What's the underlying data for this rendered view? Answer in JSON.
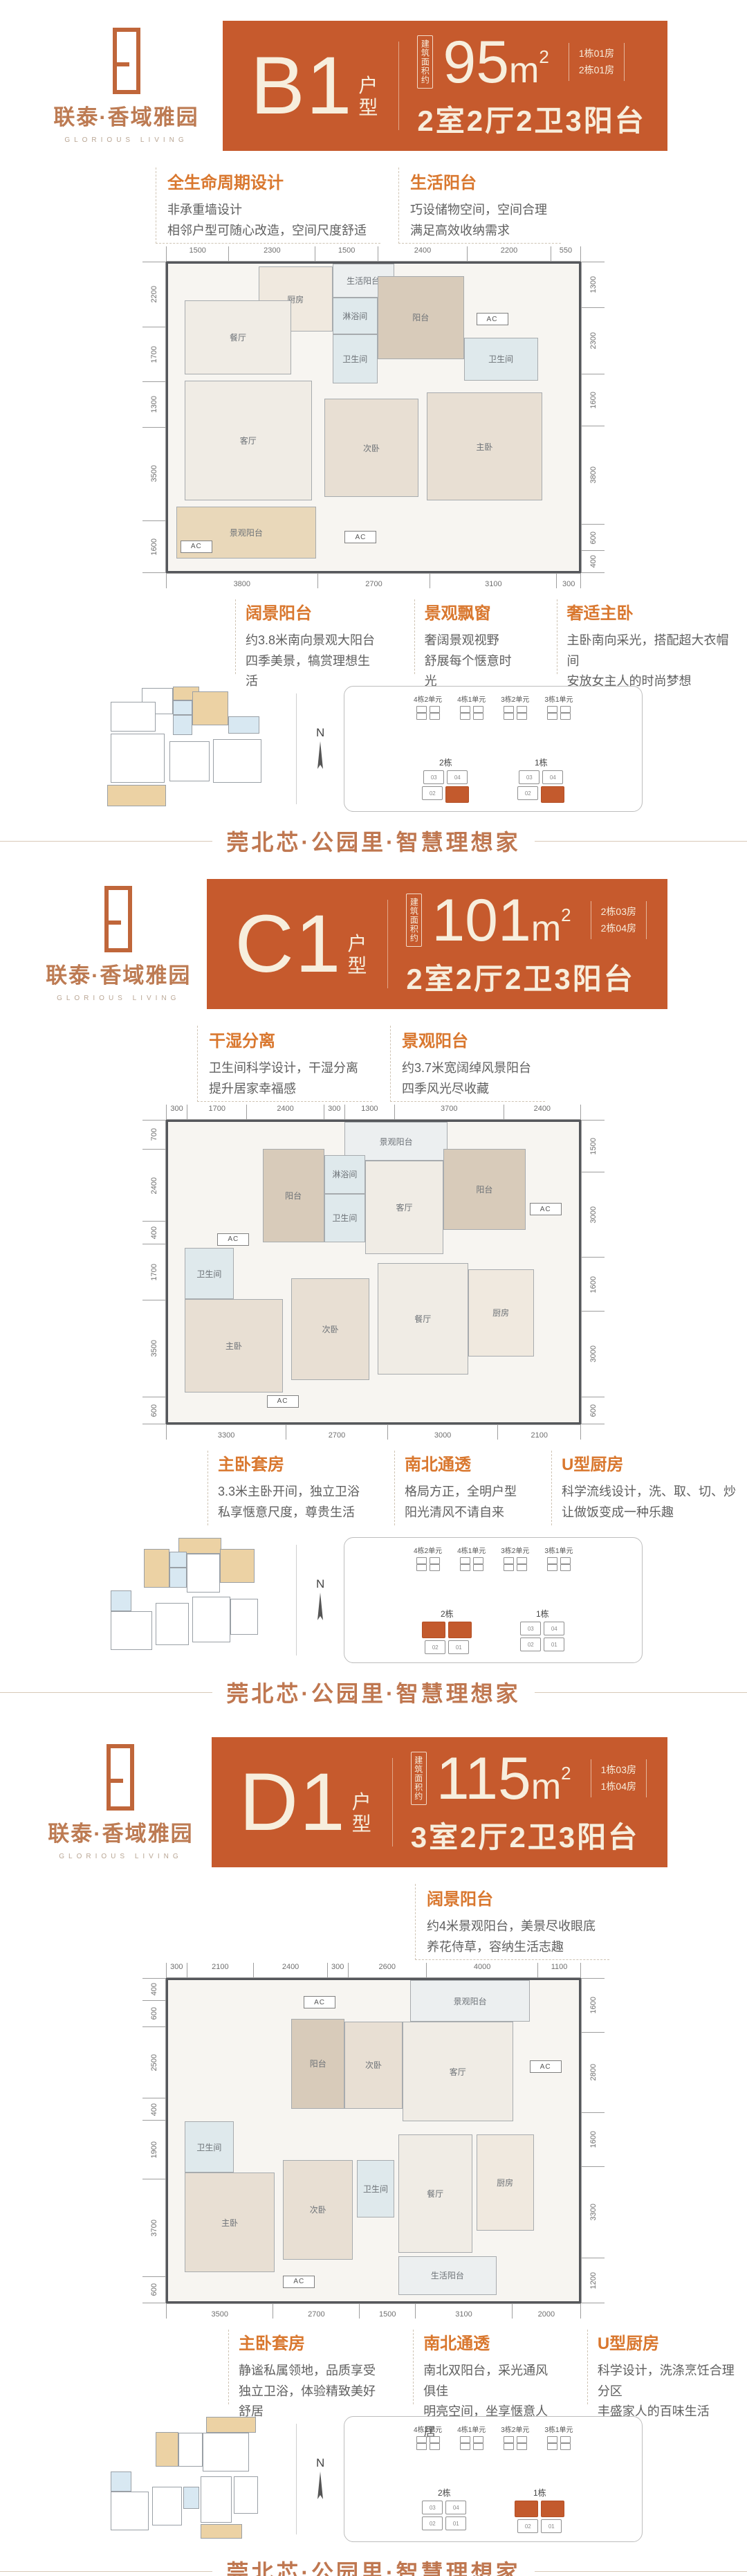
{
  "brand": {
    "cn": "联泰·香域雅园",
    "en": "GLORIOUS LIVING"
  },
  "footer_slogan": "莞北芯·公园里·智慧理想家",
  "colors": {
    "banner_orange": "#c65a2d",
    "title_orange": "#d9772e",
    "copper": "#bd7b53",
    "highlight": "#c35a2d"
  },
  "compass_label": "N",
  "sections": [
    {
      "banner": {
        "code": "B1",
        "suffix_1": "户",
        "suffix_2": "型",
        "area_label": "建筑面积约",
        "area": "95",
        "area_unit": "m",
        "area_sup": "2",
        "units": [
          "1栋01房",
          "2栋01房"
        ],
        "layout": "2室2厅2卫3阳台"
      },
      "features": [
        {
          "title": "全生命周期设计",
          "lines": [
            "非承重墙设计",
            "相邻户型可随心改造，空间尺度舒适"
          ]
        },
        {
          "title": "生活阳台",
          "lines": [
            "巧设储物空间，空间合理",
            "满足高效收纳需求"
          ]
        }
      ],
      "plan": {
        "dims_top": [
          1500,
          2300,
          1500,
          2400,
          2200,
          550
        ],
        "dims_left": [
          2200,
          1700,
          1300,
          3500,
          1600
        ],
        "dims_right": [
          1300,
          2300,
          1600,
          3800,
          600,
          400
        ],
        "dims_bottom": [
          3800,
          2700,
          3100,
          300
        ],
        "rooms": [
          {
            "label": "生活阳台",
            "x": 40,
            "y": 0,
            "w": 15,
            "h": 11,
            "bg": "#eceff0"
          },
          {
            "label": "厨房",
            "x": 22,
            "y": 1,
            "w": 18,
            "h": 21,
            "bg": "#f0e9df"
          },
          {
            "label": "淋浴间",
            "x": 40,
            "y": 11,
            "w": 11,
            "h": 12,
            "bg": "#dfe9ec"
          },
          {
            "label": "阳台",
            "x": 51,
            "y": 4,
            "w": 21,
            "h": 27,
            "bg": "#d8cbba"
          },
          {
            "label": "餐厅",
            "x": 4,
            "y": 12,
            "w": 26,
            "h": 24,
            "bg": "#f0ece5"
          },
          {
            "label": "卫生间",
            "x": 40,
            "y": 23,
            "w": 11,
            "h": 16,
            "bg": "#dfe9ec"
          },
          {
            "label": "卫生间",
            "x": 72,
            "y": 24,
            "w": 18,
            "h": 14,
            "bg": "#dfe9ec"
          },
          {
            "label": "客厅",
            "x": 4,
            "y": 38,
            "w": 31,
            "h": 39,
            "bg": "#f0ece5"
          },
          {
            "label": "次卧",
            "x": 38,
            "y": 44,
            "w": 23,
            "h": 32,
            "bg": "#e8dfd3"
          },
          {
            "label": "主卧",
            "x": 63,
            "y": 42,
            "w": 28,
            "h": 35,
            "bg": "#e8dfd3"
          },
          {
            "label": "景观阳台",
            "x": 2,
            "y": 79,
            "w": 34,
            "h": 17,
            "bg": "#e9d8ba"
          }
        ],
        "ac_badges": [
          {
            "label": "AC",
            "x": 75,
            "y": 16
          },
          {
            "label": "AC",
            "x": 43,
            "y": 87
          },
          {
            "label": "AC",
            "x": 3,
            "y": 90
          }
        ]
      },
      "annotations": [
        {
          "title": "阔景阳台",
          "lines": [
            "约3.8米南向景观大阳台",
            "四季美景，犒赏理想生活"
          ]
        },
        {
          "title": "景观飘窗",
          "lines": [
            "奢阔景观视野",
            "舒展每个惬意时光"
          ]
        },
        {
          "title": "奢适主卧",
          "lines": [
            "主卧南向采光，搭配超大衣帽间",
            "安放女主人的时尚梦想"
          ]
        }
      ],
      "site": {
        "top_clusters": [
          {
            "label": "4栋2单元"
          },
          {
            "label": "4栋1单元"
          },
          {
            "label": "3栋2单元"
          },
          {
            "label": "3栋1单元"
          }
        ],
        "bottom_clusters": [
          {
            "label": "2栋",
            "top": [
              "03",
              "04"
            ],
            "bottom": [
              "02",
              "01"
            ],
            "highlight": [
              "01"
            ]
          },
          {
            "label": "1栋",
            "top": [
              "03",
              "04"
            ],
            "bottom": [
              "02",
              "01"
            ],
            "highlight": [
              "01"
            ]
          }
        ]
      }
    },
    {
      "banner": {
        "code": "C1",
        "suffix_1": "户",
        "suffix_2": "型",
        "area_label": "建筑面积约",
        "area": "101",
        "area_unit": "m",
        "area_sup": "2",
        "units": [
          "2栋03房",
          "2栋04房"
        ],
        "layout": "2室2厅2卫3阳台"
      },
      "features": [
        {
          "title": "干湿分离",
          "lines": [
            "卫生间科学设计，干湿分离",
            "提升居家幸福感"
          ]
        },
        {
          "title": "景观阳台",
          "lines": [
            "约3.7米宽阔绰风景阳台",
            "四季风光尽收藏"
          ]
        }
      ],
      "plan": {
        "dims_top": [
          300,
          1700,
          2400,
          300,
          1300,
          3700,
          2400
        ],
        "dims_left": [
          700,
          2400,
          400,
          1700,
          3500,
          600
        ],
        "dims_right": [
          1500,
          3000,
          1600,
          3000,
          600
        ],
        "dims_bottom": [
          3300,
          2700,
          3000,
          2100
        ],
        "rooms": [
          {
            "label": "景观阳台",
            "x": 43,
            "y": 0,
            "w": 25,
            "h": 13,
            "bg": "#eceff0"
          },
          {
            "label": "阳台",
            "x": 23,
            "y": 9,
            "w": 15,
            "h": 31,
            "bg": "#d8cbba"
          },
          {
            "label": "淋浴间",
            "x": 38,
            "y": 11,
            "w": 10,
            "h": 13,
            "bg": "#dfe9ec"
          },
          {
            "label": "卫生间",
            "x": 38,
            "y": 24,
            "w": 10,
            "h": 16,
            "bg": "#dfe9ec"
          },
          {
            "label": "客厅",
            "x": 48,
            "y": 13,
            "w": 19,
            "h": 31,
            "bg": "#f0ece5"
          },
          {
            "label": "阳台",
            "x": 67,
            "y": 9,
            "w": 20,
            "h": 27,
            "bg": "#d8cbba"
          },
          {
            "label": "卫生间",
            "x": 4,
            "y": 42,
            "w": 12,
            "h": 17,
            "bg": "#dfe9ec"
          },
          {
            "label": "主卧",
            "x": 4,
            "y": 59,
            "w": 24,
            "h": 31,
            "bg": "#e8dfd3"
          },
          {
            "label": "次卧",
            "x": 30,
            "y": 52,
            "w": 19,
            "h": 34,
            "bg": "#e8dfd3"
          },
          {
            "label": "餐厅",
            "x": 51,
            "y": 47,
            "w": 22,
            "h": 37,
            "bg": "#f0ece5"
          },
          {
            "label": "厨房",
            "x": 73,
            "y": 49,
            "w": 16,
            "h": 29,
            "bg": "#f0e9df"
          }
        ],
        "ac_badges": [
          {
            "label": "AC",
            "x": 12,
            "y": 37
          },
          {
            "label": "AC",
            "x": 88,
            "y": 27
          },
          {
            "label": "AC",
            "x": 24,
            "y": 91
          }
        ]
      },
      "annotations": [
        {
          "title": "主卧套房",
          "lines": [
            "3.3米主卧开间，独立卫浴",
            "私享惬意尺度，尊贵生活"
          ]
        },
        {
          "title": "南北通透",
          "lines": [
            "格局方正，全明户型",
            "阳光清风不请自来"
          ]
        },
        {
          "title": "U型厨房",
          "lines": [
            "科学流线设计，洗、取、切、炒",
            "让做饭变成一种乐趣"
          ]
        }
      ],
      "site": {
        "top_clusters": [
          {
            "label": "4栋2单元"
          },
          {
            "label": "4栋1单元"
          },
          {
            "label": "3栋2单元"
          },
          {
            "label": "3栋1单元"
          }
        ],
        "bottom_clusters": [
          {
            "label": "2栋",
            "top": [
              "03",
              "04"
            ],
            "bottom": [
              "02",
              "01"
            ],
            "highlight": [
              "03",
              "04"
            ]
          },
          {
            "label": "1栋",
            "top": [
              "03",
              "04"
            ],
            "bottom": [
              "02",
              "01"
            ],
            "highlight": []
          }
        ]
      }
    },
    {
      "banner": {
        "code": "D1",
        "suffix_1": "户",
        "suffix_2": "型",
        "area_label": "建筑面积约",
        "area": "115",
        "area_unit": "m",
        "area_sup": "2",
        "units": [
          "1栋03房",
          "1栋04房"
        ],
        "layout": "3室2厅2卫3阳台"
      },
      "features": [
        {
          "title": "阔景阳台",
          "lines": [
            "约4米景观阳台，美景尽收眼底",
            "养花侍草，容纳生活志趣"
          ]
        }
      ],
      "plan": {
        "dims_top": [
          300,
          2100,
          2400,
          300,
          2600,
          4000,
          1100
        ],
        "dims_left": [
          400,
          600,
          2500,
          400,
          1900,
          3700,
          600
        ],
        "dims_right": [
          1600,
          2800,
          1600,
          3300,
          1200
        ],
        "dims_bottom": [
          3500,
          2700,
          1500,
          3100,
          2000
        ],
        "rooms": [
          {
            "label": "景观阳台",
            "x": 59,
            "y": 0,
            "w": 29,
            "h": 13,
            "bg": "#eceff0"
          },
          {
            "label": "客厅",
            "x": 57,
            "y": 13,
            "w": 27,
            "h": 31,
            "bg": "#f0ece5"
          },
          {
            "label": "阳台",
            "x": 30,
            "y": 12,
            "w": 13,
            "h": 28,
            "bg": "#d8cbba"
          },
          {
            "label": "次卧",
            "x": 43,
            "y": 13,
            "w": 14,
            "h": 27,
            "bg": "#e8dfd3"
          },
          {
            "label": "卫生间",
            "x": 4,
            "y": 44,
            "w": 12,
            "h": 16,
            "bg": "#dfe9ec"
          },
          {
            "label": "主卧",
            "x": 4,
            "y": 60,
            "w": 22,
            "h": 31,
            "bg": "#e8dfd3"
          },
          {
            "label": "次卧",
            "x": 28,
            "y": 56,
            "w": 17,
            "h": 31,
            "bg": "#e8dfd3"
          },
          {
            "label": "卫生间",
            "x": 46,
            "y": 56,
            "w": 9,
            "h": 18,
            "bg": "#dfe9ec"
          },
          {
            "label": "餐厅",
            "x": 56,
            "y": 48,
            "w": 18,
            "h": 37,
            "bg": "#f0ece5"
          },
          {
            "label": "厨房",
            "x": 75,
            "y": 48,
            "w": 14,
            "h": 30,
            "bg": "#f0e9df"
          },
          {
            "label": "生活阳台",
            "x": 56,
            "y": 86,
            "w": 24,
            "h": 12,
            "bg": "#eceff0"
          }
        ],
        "ac_badges": [
          {
            "label": "AC",
            "x": 33,
            "y": 5
          },
          {
            "label": "AC",
            "x": 88,
            "y": 25
          },
          {
            "label": "AC",
            "x": 28,
            "y": 92
          }
        ]
      },
      "annotations": [
        {
          "title": "主卧套房",
          "lines": [
            "静谧私属领地，品质享受",
            "独立卫浴，体验精致美好舒居"
          ]
        },
        {
          "title": "南北通透",
          "lines": [
            "南北双阳台，采光通风俱佳",
            "明亮空间，坐享惬意人居"
          ]
        },
        {
          "title": "U型厨房",
          "lines": [
            "科学设计，洗涤烹饪合理分区",
            "丰盛家人的百味生活"
          ]
        }
      ],
      "site": {
        "top_clusters": [
          {
            "label": "4栋2单元"
          },
          {
            "label": "4栋1单元"
          },
          {
            "label": "3栋2单元"
          },
          {
            "label": "3栋1单元"
          }
        ],
        "bottom_clusters": [
          {
            "label": "2栋",
            "top": [
              "03",
              "04"
            ],
            "bottom": [
              "02",
              "01"
            ],
            "highlight": []
          },
          {
            "label": "1栋",
            "top": [
              "03",
              "04"
            ],
            "bottom": [
              "02",
              "01"
            ],
            "highlight": [
              "03",
              "04"
            ]
          }
        ]
      }
    }
  ]
}
